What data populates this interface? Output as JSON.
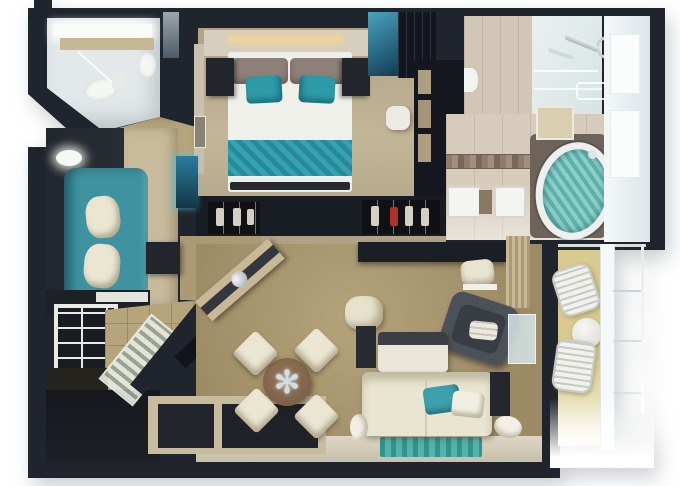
{
  "scene": {
    "kind": "3d-floor-plan-render",
    "background": "#ffffff",
    "table_star_glyph": "✻"
  },
  "palette": {
    "wall": "#20252d",
    "wall_deep": "#14171d",
    "bedroom_floor": "#b8ab8d",
    "living_carpet": "#a5936c",
    "entry_tile": "#b6a47d",
    "sitting_carpet": "#c8bb9c",
    "bath_floor": "#e3e9ea",
    "bath2_tile": "#d7ccbc",
    "teal_sofa": "#3f93a0",
    "teal_bedding": "#2e9aa8",
    "teal_rug": "#3aa29b",
    "tub_water": "#7cc5bf",
    "cream": "#ebe6d2",
    "white_soft": "#f2f2ec",
    "balcony_floor": "#d9cb8f",
    "counter_beige": "#c8b795",
    "glass": "#dfeae8"
  },
  "rooms": [
    {
      "id": "guest-bathroom",
      "furniture": [
        "vanity-counter",
        "sink",
        "toilet",
        "glass-shower"
      ]
    },
    {
      "id": "bedroom",
      "furniture": [
        "double-bed",
        "taupe-pillows",
        "teal-accent-pillows",
        "teal-bed-runner",
        "nightstand-left",
        "nightstand-right",
        "headboard-light-strip",
        "teal-glass-panel",
        "tv-unit",
        "wardrobe-shelves",
        "vanity-stool",
        "shoe-closet-left",
        "shoe-closet-right"
      ]
    },
    {
      "id": "master-bathroom",
      "furniture": [
        "glass-shower",
        "shower-fixture",
        "towel-bar",
        "wall-sink",
        "mosaic-tile-strip",
        "double-sinks",
        "oval-jacuzzi-tub",
        "window-wall"
      ]
    },
    {
      "id": "lounge",
      "furniture": [
        "teal-sofa",
        "cream-pillows",
        "side-table",
        "floor-lamp",
        "backlit-cabinet",
        "dresser"
      ]
    },
    {
      "id": "entry-hall",
      "furniture": [
        "cubby-shelf-unit",
        "slatted-glass-partition",
        "angled-wall",
        "cabinet",
        "dark-entry-floor"
      ]
    },
    {
      "id": "living-dining-room",
      "furniture": [
        "angled-bar-credenza",
        "ice-bucket",
        "round-dining-table",
        "dining-chair-1",
        "dining-chair-2",
        "dining-chair-3",
        "dining-chair-4",
        "ottoman-pouf",
        "wall-desk",
        "desk-chair",
        "curtain-panel",
        "armchair",
        "coffee-table",
        "side-cube-table",
        "cream-sofa",
        "teal-throw-pillow",
        "white-throw-pillow",
        "bolster-left",
        "bolster-right",
        "sofa-end-table",
        "teal-area-rug",
        "window-bench",
        "balcony-glass-door"
      ]
    },
    {
      "id": "balcony",
      "furniture": [
        "wire-chair-upper",
        "wire-chair-lower",
        "round-cafe-table",
        "railing"
      ]
    }
  ]
}
